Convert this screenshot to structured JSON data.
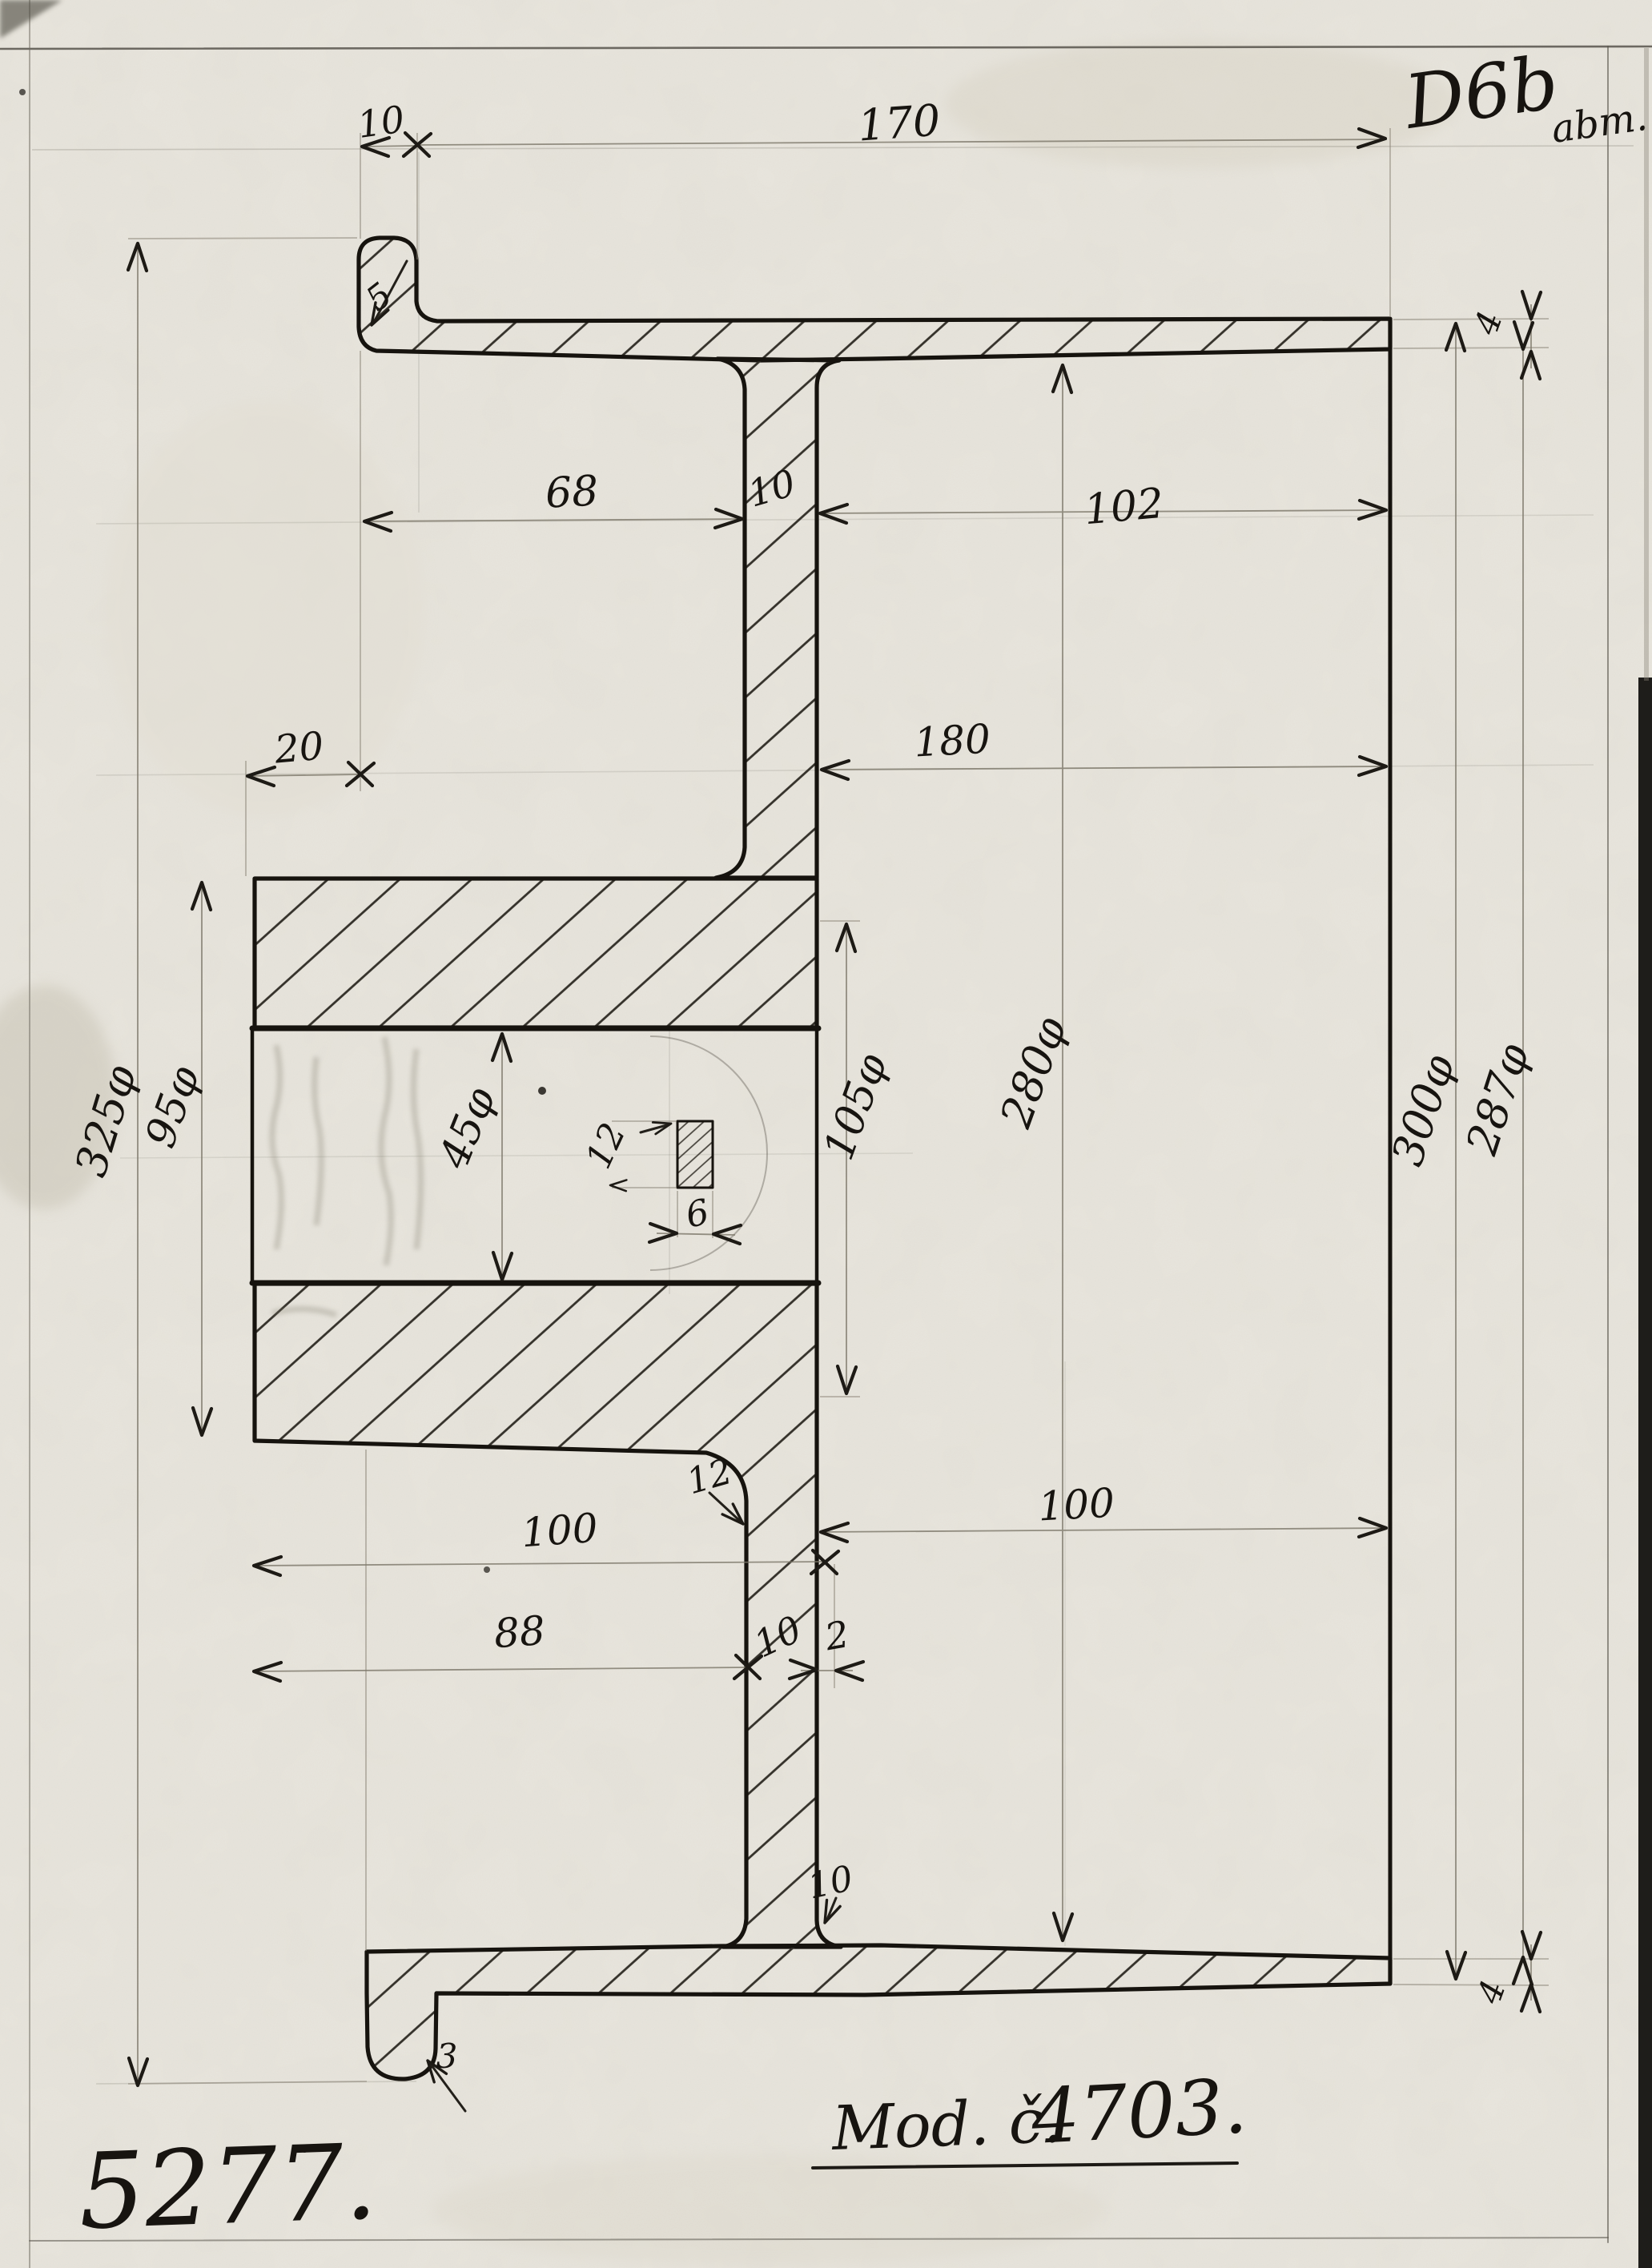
{
  "sheet": {
    "corner_code": "D6b",
    "corner_code_suffix": "abm.",
    "drawing_number": "5277.",
    "model_prefix": "Mod. č.",
    "model_number": "4703."
  },
  "dims": {
    "top_lip_width": "10",
    "overall_width": "170",
    "lug_fillet_radius": "5",
    "flange_left_to_web": "68",
    "web_thickness_top": "10",
    "web_to_right_face": "102",
    "hub_overhang": "20",
    "hub_to_right_face": "180",
    "outer_flange_diameter": "325φ",
    "hub_diameter_left": "95φ",
    "bore_diameter": "45φ",
    "keyway_height": "12",
    "keyway_width": "6",
    "hub_diameter_right": "105φ",
    "rim_inner_diameter": "280φ",
    "rim_outer_diameter": "300φ",
    "rim_lip_diameter": "287φ",
    "rim_edge_thickness_top": "4",
    "rim_edge_thickness_bottom": "4",
    "hub_width": "100",
    "hub_to_web_lower": "88",
    "web_thickness_bottom": "10",
    "web_offset_step": "2",
    "hub_to_right_face_lower": "100",
    "hub_fillet_radius": "12",
    "rim_fillet_radius": "10",
    "bottom_lug_fillet_radius": "3"
  }
}
